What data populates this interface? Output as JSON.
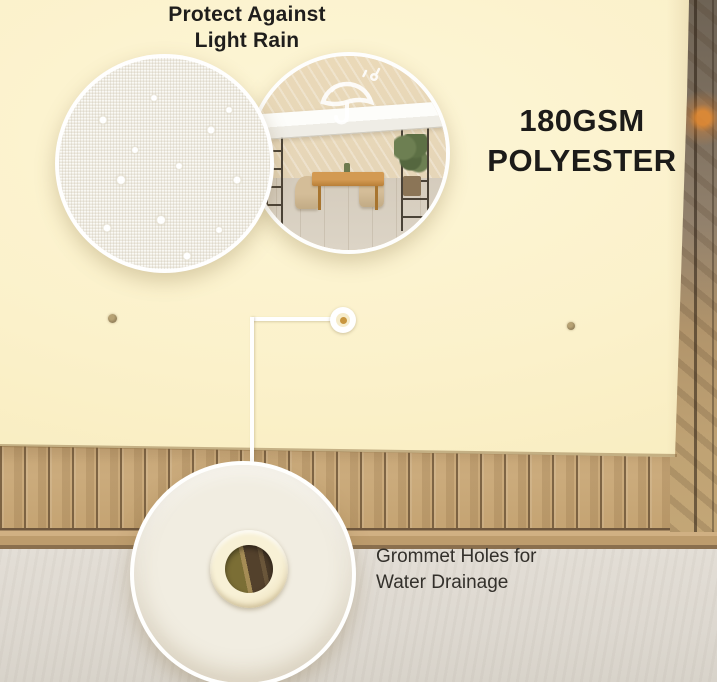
{
  "callouts": {
    "rain": {
      "line1": "Protect Against",
      "line2": "Light Rain"
    },
    "spec": {
      "line1": "180GSM",
      "line2": "POLYESTER"
    },
    "grommet": {
      "line1": "Grommet Holes for",
      "line2": "Water Drainage"
    }
  },
  "icons": {
    "umbrella": "umbrella-rain-icon",
    "grommet_marker": "grommet-point-marker"
  },
  "colors": {
    "tarp_cream": "#fbf1ca",
    "text_dark": "#1f1e1c",
    "wood_slat": "#c7a777",
    "floor_grey": "#dfdad2",
    "grommet_ring": "#f2e9cb",
    "accent_orange_glow": "#e98c30",
    "connector_white": "#ffffff"
  }
}
